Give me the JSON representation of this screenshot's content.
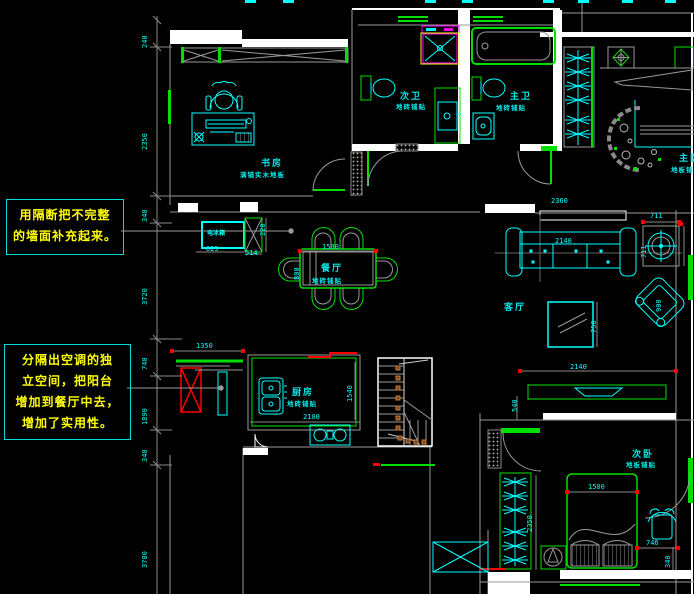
{
  "annotations": {
    "note1": {
      "line1": "用隔断把不完整",
      "line2": "的墙面补充起来。"
    },
    "note2": {
      "line1": "分隔出空调的独",
      "line2": "立空间，把阳台",
      "line3": "增加到餐厅中去，",
      "line4": "增加了实用性。"
    }
  },
  "rooms": {
    "study": {
      "name": "书房",
      "finish": "满铺实木地板"
    },
    "bath2": {
      "name": "次卫",
      "finish": "地砖铺贴"
    },
    "bath1": {
      "name": "主卫",
      "finish": "地砖铺贴"
    },
    "dining": {
      "name": "餐厅",
      "finish": "地砖铺贴"
    },
    "living": {
      "name": "客厅"
    },
    "kitchen": {
      "name": "厨房",
      "finish": "地砖铺贴"
    },
    "bed2": {
      "name": "次卧",
      "finish": "地板铺贴"
    },
    "bed1": {
      "name": "主卧",
      "finish": "地板铺贴"
    }
  },
  "fixtures": {
    "fridge": "电冰箱"
  },
  "dims": {
    "left_chain": [
      "240",
      "2350",
      "340",
      "3720",
      "740",
      "1890",
      "340",
      "3780"
    ],
    "fridge_w": "829",
    "cab_w": "514",
    "cab_d": "220",
    "table_w": "1500",
    "table_d": "800",
    "balcony_w": "1350",
    "kitchen_w": "2100",
    "kitchen_d": "1540",
    "sofa_w": "2140",
    "niche_w": "2360",
    "fan_w": "711",
    "fan_h": "711",
    "coffee_d": "750",
    "armchair_d": "900",
    "tv_w": "2140",
    "bed_w": "1500",
    "bed_gap": "746",
    "gap_d": "340",
    "wardrobe_h": "2350",
    "door_w": "540"
  },
  "colors": {
    "cyan": "#00ffff",
    "green": "#00e000",
    "red": "#ff0000",
    "magenta": "#ff00ff",
    "yellow": "#ffff00",
    "wall": "#ffffff",
    "construction": "#9a9a9a",
    "baluster": "#c87c38"
  }
}
